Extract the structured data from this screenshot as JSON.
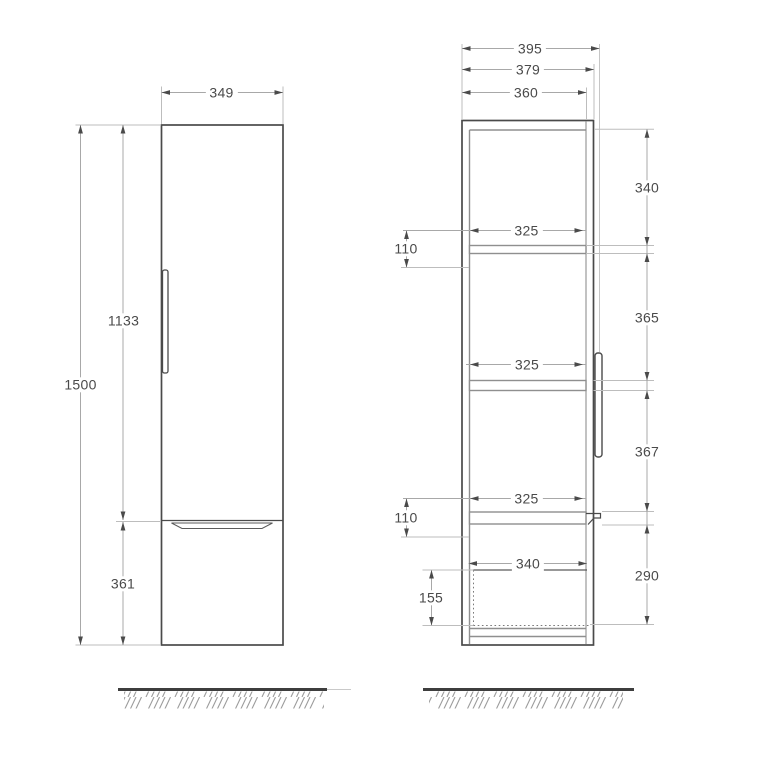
{
  "drawing": {
    "type": "furniture-technical-drawing",
    "colors": {
      "background": "#ffffff",
      "outline": "#4a4a4a",
      "inner_line": "#8f8f8f",
      "dim_line": "#a8a8a8",
      "text": "#4a4a4a",
      "ground": "#3e3e3e",
      "hatch": "#9c9c9c"
    },
    "front_view": {
      "width": "349",
      "total_height": "1500",
      "door_height": "1133",
      "drawer_height": "361"
    },
    "side_view": {
      "depth_total": "395",
      "depth_with_door": "379",
      "depth_carcass": "360",
      "top_to_shelf1": "340",
      "shelf1_to_shelf2": "365",
      "shelf2_to_shelf3": "367",
      "bottom_section": "290",
      "shelf_depth_top": "325",
      "shelf_depth_mid": "325",
      "shelf_depth_low": "325",
      "rail_offset_top": "110",
      "rail_offset_bottom": "110",
      "drawer_depth": "340",
      "drawer_inner_height": "155"
    }
  }
}
